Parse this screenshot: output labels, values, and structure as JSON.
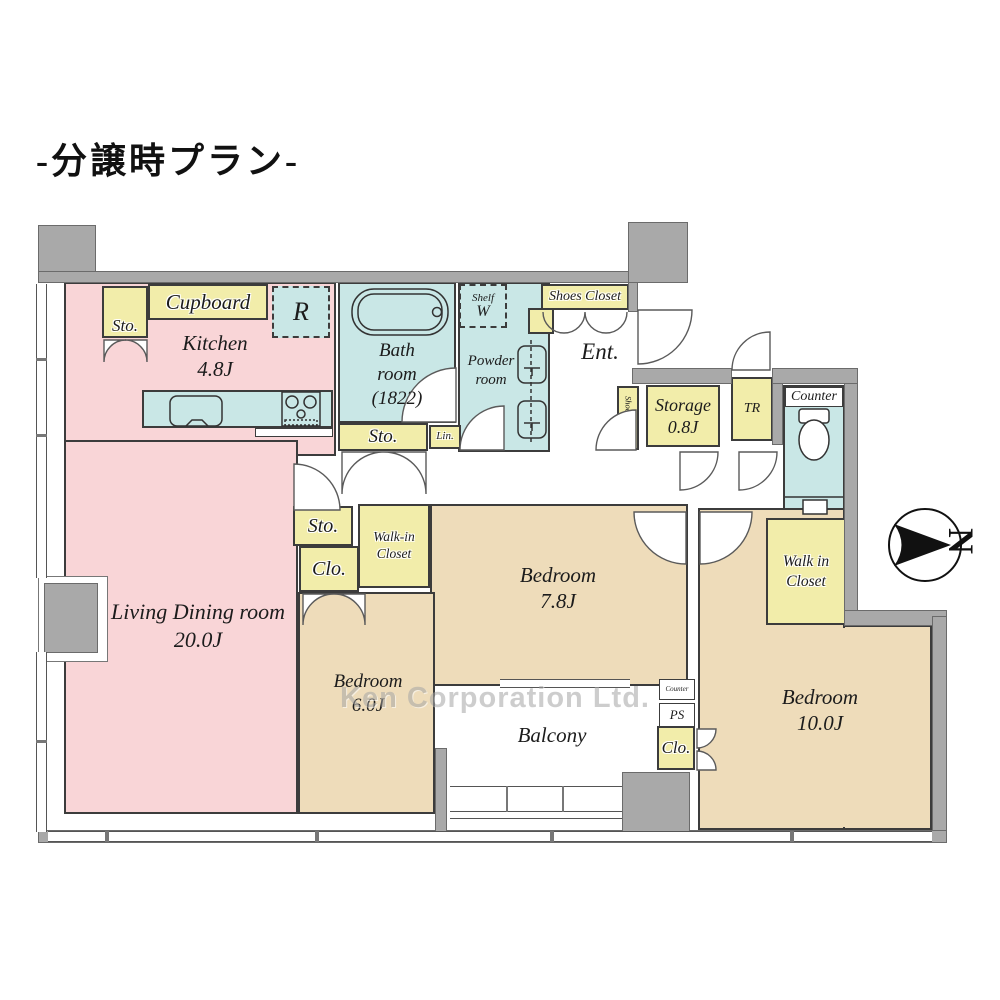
{
  "title": "-分譲時プラン-",
  "watermark": "Ken Corporation Ltd.",
  "compass": {
    "north_letter": "N"
  },
  "colors": {
    "room_pink": "#f9d5d7",
    "room_tan": "#eedcba",
    "wet_cyan": "#c9e7e6",
    "closet_yellow": "#f2edaa",
    "wall_gray": "#a9a9a9"
  },
  "rooms": {
    "kitchen": {
      "name": "Kitchen",
      "size": "4.8J"
    },
    "bathroom": {
      "name_line1": "Bath",
      "name_line2": "room",
      "size": "(1822)"
    },
    "powder_room": {
      "name_line1": "Powder",
      "name_line2": "room"
    },
    "entrance": {
      "name": "Ent."
    },
    "living_dining": {
      "name": "Living Dining room",
      "size": "20.0J"
    },
    "bedroom_center": {
      "name": "Bedroom",
      "size": "7.8J"
    },
    "bedroom_left": {
      "name": "Bedroom",
      "size": "6.0J"
    },
    "bedroom_right": {
      "name": "Bedroom",
      "size": "10.0J"
    },
    "balcony": {
      "name": "Balcony"
    },
    "storage_room": {
      "name": "Storage",
      "size": "0.8J"
    }
  },
  "closets": {
    "cupboard": "Cupboard",
    "kitchen_storage": "Sto.",
    "hall_storage": "Sto.",
    "linen": "Lin.",
    "shoes_closet_front": "Shoes Closet",
    "shoes_closet_side": "Shoes Closet",
    "trunk_room": "TR",
    "storage_mid": "Sto.",
    "closet_mid": "Clo.",
    "walk_in_closet_center": {
      "line1": "Walk-in",
      "line2": "Closet"
    },
    "walk_in_closet_right": {
      "line1": "Walk in",
      "line2": "Closet"
    },
    "closet_bottom": "Clo."
  },
  "fixtures": {
    "refrigerator": "R",
    "washer_shelf": {
      "line1": "Shelf",
      "line2": "W"
    },
    "toilet_counter": "Counter",
    "counter_small": "Counter",
    "pipe_space": "PS"
  }
}
